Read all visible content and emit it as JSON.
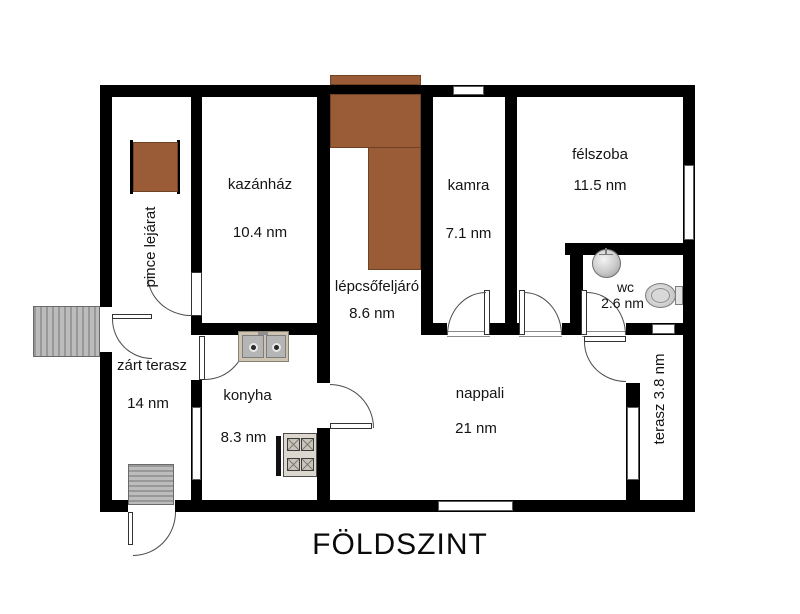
{
  "title": "FÖLDSZINT",
  "unit": "nm",
  "colors": {
    "wall": "#000000",
    "stairs_brown": "#9a5c36",
    "stairs_gray": "#b3b3b3",
    "background": "#ffffff"
  },
  "rooms": [
    {
      "id": "pince-lejarat",
      "label": "pince lejárat",
      "area": ""
    },
    {
      "id": "kazanhaz",
      "label": "kazánház",
      "area": "10.4 nm"
    },
    {
      "id": "lepcsofeljaro",
      "label": "lépcsőfeljáró",
      "area": "8.6 nm"
    },
    {
      "id": "kamra",
      "label": "kamra",
      "area": "7.1 nm"
    },
    {
      "id": "felszoba",
      "label": "félszoba",
      "area": "11.5 nm"
    },
    {
      "id": "wc",
      "label": "wc",
      "area": "2.6 nm"
    },
    {
      "id": "zart-terasz",
      "label": "zárt terasz",
      "area": "14 nm"
    },
    {
      "id": "konyha",
      "label": "konyha",
      "area": "8.3 nm"
    },
    {
      "id": "nappali",
      "label": "nappali",
      "area": "21 nm"
    },
    {
      "id": "terasz",
      "label": "terasz 3.8 nm",
      "area": ""
    }
  ],
  "fixtures": [
    "kitchen-double-sink",
    "gas-stove",
    "wc-washbasin",
    "toilet",
    "basement-staircase",
    "upper-staircase",
    "exterior-entry-stairs",
    "terrace-exit-steps"
  ]
}
